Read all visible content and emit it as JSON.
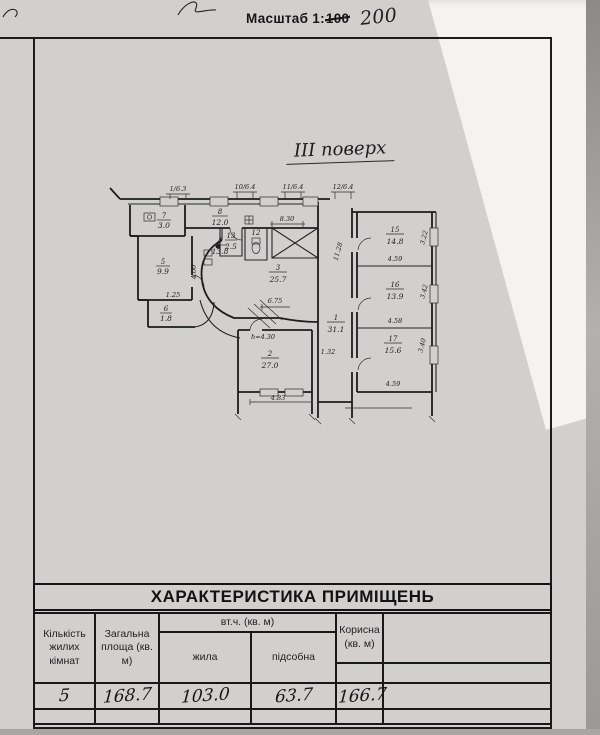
{
  "header": {
    "scale_prefix": "Масштаб 1:",
    "scale_crossed": "100",
    "scale_handwritten": "200"
  },
  "plan": {
    "floor_title": "III поверх",
    "rooms": [
      {
        "num": "1",
        "area": "31.1"
      },
      {
        "num": "2",
        "area": "27.0"
      },
      {
        "num": "3",
        "area": "25.7"
      },
      {
        "num": "4",
        "area": "13.8"
      },
      {
        "num": "5",
        "area": "9.9"
      },
      {
        "num": "6",
        "area": "1.8"
      },
      {
        "num": "7",
        "area": "3.0"
      },
      {
        "num": "8",
        "area": "12.0"
      },
      {
        "num": "12",
        "area": ""
      },
      {
        "num": "13",
        "area": "2.5"
      },
      {
        "num": "15",
        "area": "14.8"
      },
      {
        "num": "16",
        "area": "13.9"
      },
      {
        "num": "17",
        "area": "15.6"
      }
    ],
    "dims": {
      "top1": "1/6.3",
      "top2": "10/6.4",
      "top3": "11/6.4",
      "top4": "12/6.4",
      "d830": "8.30",
      "d675": "6.75",
      "d483": "4.83",
      "d1128": "11.28",
      "d132": "1.32",
      "d400": "4.00",
      "d125": "1.25",
      "h430": "h=4.30",
      "w15": "4.59",
      "h15": "3.22",
      "w16": "4.58",
      "h16": "3.42",
      "w17": "4.59",
      "h17": "3.40"
    }
  },
  "table": {
    "title": "ХАРАКТЕРИСТИКА ПРИМІЩЕНЬ",
    "headers": {
      "rooms_count": "Кількість жилих кімнат",
      "total_area": "Загальна площа (кв. м)",
      "including": "вт.ч. (кв. м)",
      "living": "жила",
      "auxiliary": "підсобна",
      "useful": "Корисна (кв. м)"
    },
    "values": {
      "rooms_count": "5",
      "total_area": "168.7",
      "living": "103.0",
      "auxiliary": "63.7",
      "useful": "166.7"
    }
  }
}
